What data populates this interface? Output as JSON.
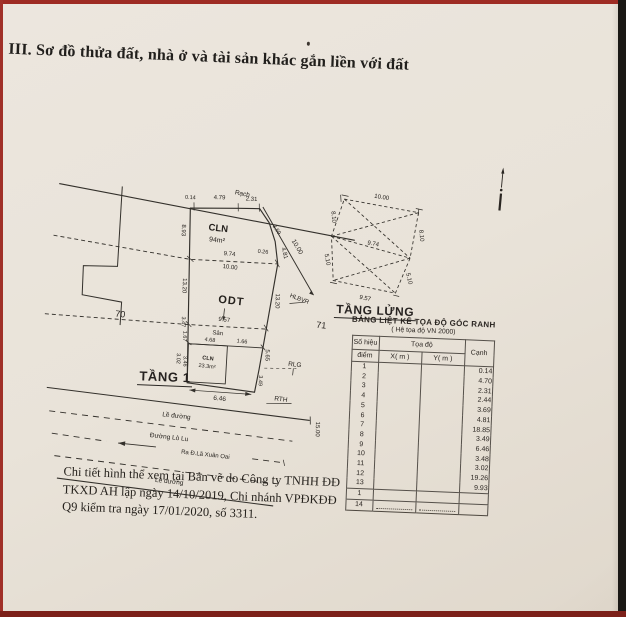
{
  "page": {
    "section_title": "III. Sơ đồ thửa đất, nhà ở và tài sản khác gắn liền với đất"
  },
  "colors": {
    "frame_red": "#9e2b23",
    "frame_black": "#1a1815",
    "paper": "#e8e2d8",
    "ink": "#26221e"
  },
  "plot": {
    "labels": {
      "canal": "Rạch",
      "d014": "0.14",
      "d479": "4.79",
      "d231": "2.31",
      "cln": "CLN",
      "cln_area": "94m²",
      "d893": "8.93",
      "d1320_left": "13.20",
      "d347": "3.47",
      "d167": "1.67",
      "d302": "3.02",
      "d346": "3.46",
      "cln2": "CLN",
      "cln2_area": "23.3m²",
      "d974": "9.74",
      "d1000_inner": "10.00",
      "d026": "0.26",
      "odt": "ODT",
      "d957": "9.57",
      "san": "Sân",
      "d468": "4.68",
      "d166": "1.66",
      "d646": "6.46",
      "d349": "3.49",
      "d565": "5.65",
      "d1320_right": "13.20",
      "d481": "4.81",
      "d369": "3.69",
      "d1000_hlbvr": "10.00",
      "hlbvr": "HLBVR",
      "p70": "70",
      "p71": "71",
      "rlg": "RLG",
      "rth": "RTH",
      "d1500": "15.00",
      "le_duong_1": "Lề đường",
      "duong_lo_lu": "Đường Lò Lu",
      "ra_duong": "Ra Đ.Lã Xuân Oai",
      "le_duong_2": "Lề đường"
    }
  },
  "floors": {
    "tang1": "TẦNG 1",
    "tang_lung": "TẦNG LỬNG"
  },
  "mezzanine": {
    "d1000": "10.00",
    "d810_left": "8.10",
    "d510_left": "5.10",
    "d974": "9.74",
    "d810_right": "8.10",
    "d510_right": "5.10",
    "d957": "9.57"
  },
  "table": {
    "title": "BẢNG LIỆT KÊ TỌA ĐỘ GÓC RANH",
    "subtitle": "( Hệ tọa độ VN 2000)",
    "col_point_line1": "Số hiệu",
    "col_point_line2": "điểm",
    "col_coord": "Tọa độ",
    "col_x": "X( m )",
    "col_y": "Y( m )",
    "col_edge": "Cạnh",
    "rows": [
      {
        "id": "1",
        "edge": "0.14"
      },
      {
        "id": "2",
        "edge": "4.70"
      },
      {
        "id": "3",
        "edge": "2.31"
      },
      {
        "id": "4",
        "edge": "2.44"
      },
      {
        "id": "5",
        "edge": "3.69"
      },
      {
        "id": "6",
        "edge": "4.81"
      },
      {
        "id": "7",
        "edge": "18.85"
      },
      {
        "id": "8",
        "edge": "3.49"
      },
      {
        "id": "9",
        "edge": "6.46"
      },
      {
        "id": "10",
        "edge": "3.48"
      },
      {
        "id": "11",
        "edge": "3.02"
      },
      {
        "id": "12",
        "edge": "19.26"
      },
      {
        "id": "13",
        "edge": "9.93"
      },
      {
        "id": "1",
        "edge": ""
      },
      {
        "id": "14",
        "edge": ""
      }
    ]
  },
  "note": {
    "line1": "Chi tiết hình thể xem tại Bản vẽ do Công ty TNHH ĐĐ",
    "line2": "TKXD AH lập ngày 14/10/2019, Chi nhánh VPĐKĐĐ",
    "line3": "Q9 kiểm tra ngày 17/01/2020, số 3311."
  }
}
